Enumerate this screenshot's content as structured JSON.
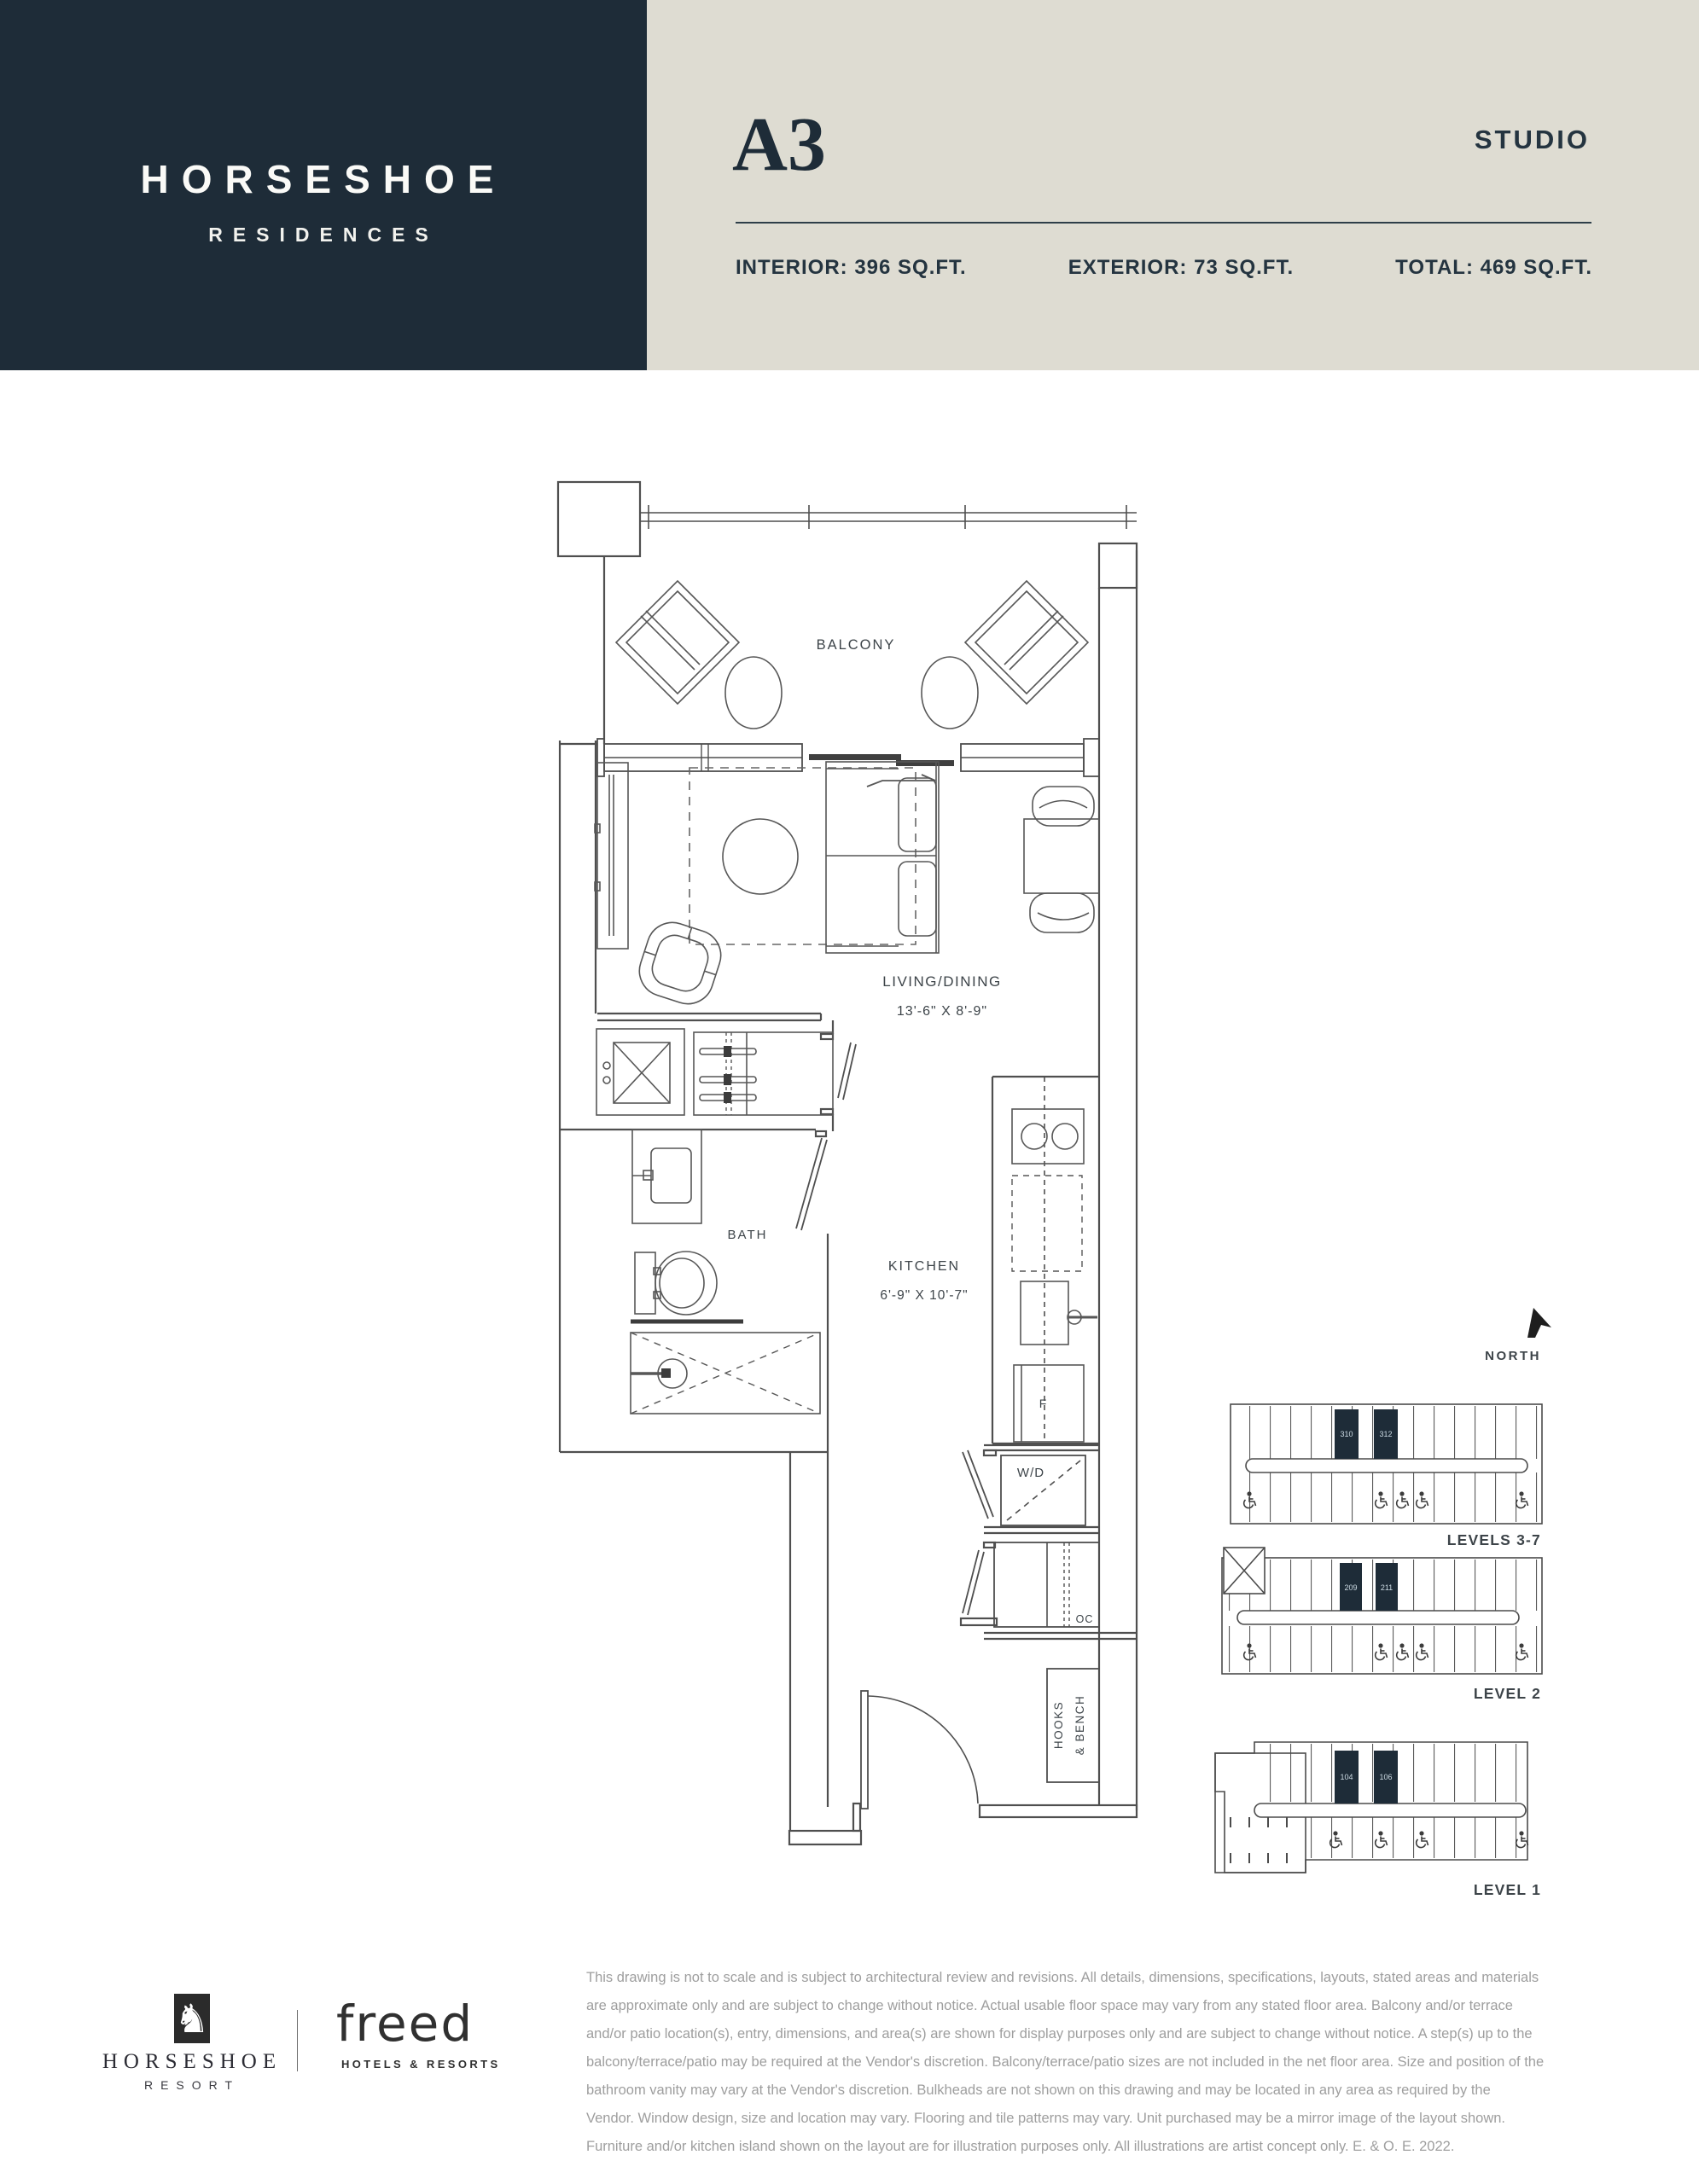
{
  "header": {
    "brand": "HORSESHOE",
    "brand_sub": "RESIDENCES",
    "unit": "A3",
    "unit_type": "STUDIO",
    "interior": "INTERIOR: 396 SQ.FT.",
    "exterior": "EXTERIOR: 73 SQ.FT.",
    "total": "TOTAL: 469 SQ.FT."
  },
  "plan": {
    "balcony": "BALCONY",
    "living": "LIVING/DINING",
    "living_dims": "13'-6\" X 8'-9\"",
    "bath": "BATH",
    "kitchen": "KITCHEN",
    "kitchen_dims": "6'-9\" X 10'-7\"",
    "wd": "W/D",
    "oc": "OC",
    "fridge": "F",
    "hooks1": "HOOKS",
    "hooks2": "& BENCH"
  },
  "keyplans": {
    "north": "NORTH",
    "levels": [
      {
        "label": "LEVELS 3-7",
        "units": [
          "310",
          "312"
        ]
      },
      {
        "label": "LEVEL 2",
        "units": [
          "209",
          "211"
        ]
      },
      {
        "label": "LEVEL 1",
        "units": [
          "104",
          "106"
        ]
      }
    ]
  },
  "footer": {
    "resort": "HORSESHOE",
    "resort_sub": "RESORT",
    "partner": "freed",
    "partner_sub": "HOTELS & RESORTS",
    "horse_glyph": "♞",
    "disclaimer_lines": [
      "This drawing is not to scale and is subject to architectural review and revisions. All details, dimensions, specifications, layouts, stated areas and materials",
      "are approximate only and are subject to change without notice. Actual usable floor space may vary from any stated floor area. Balcony and/or terrace",
      "and/or patio location(s), entry, dimensions, and area(s) are shown for display purposes only and are subject to change without notice. A step(s) up to the",
      "balcony/terrace/patio may be required at the Vendor's discretion. Balcony/terrace/patio sizes are not included in the net floor area. Size and position of the",
      "bathroom vanity may vary at the Vendor's discretion. Bulkheads are not shown on this drawing and may be located in any area as required by the",
      "Vendor. Window design, size and location may vary. Flooring and tile patterns may vary. Unit purchased may be a mirror image of the layout shown.",
      "Furniture and/or kitchen island shown on the layout are for illustration purposes only. All illustrations are artist concept only. E. & O. E. 2022."
    ]
  },
  "colors": {
    "navy": "#1e2c38",
    "beige": "#dedcd2",
    "ink": "#243440",
    "plan_line": "#4f4f4f",
    "muted_text": "#9e9e9e",
    "keyplan_number": "#cddbe4"
  }
}
